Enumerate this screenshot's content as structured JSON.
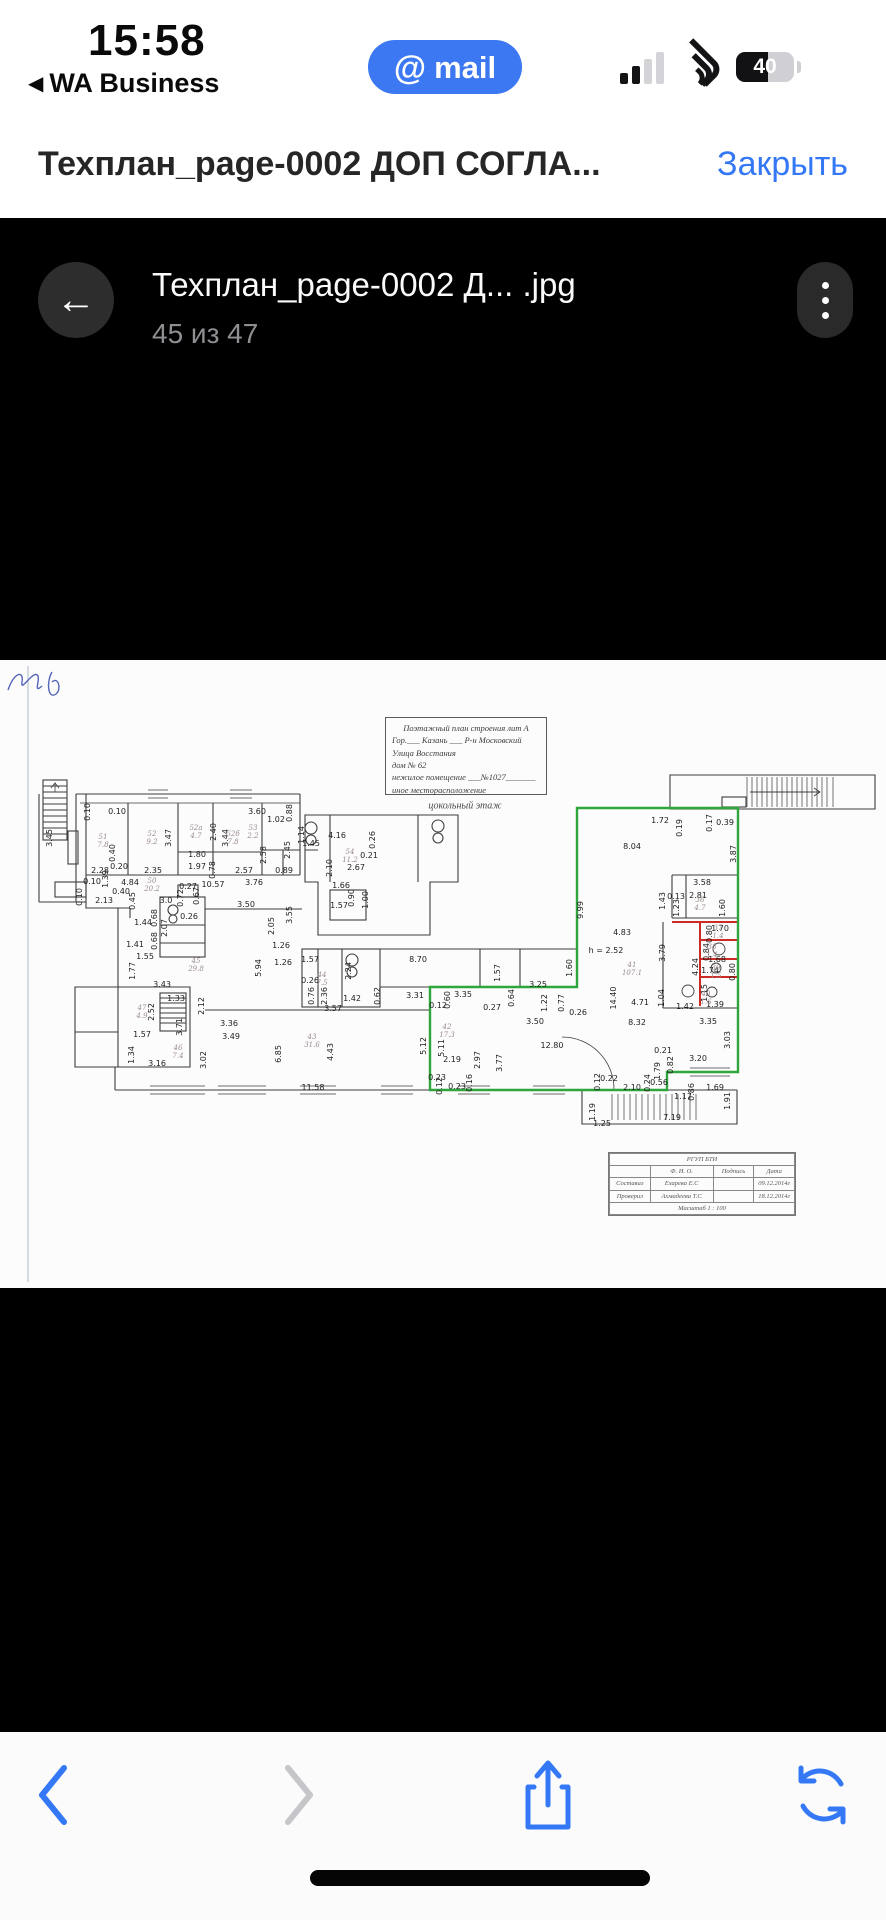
{
  "status_bar": {
    "time": "15:58",
    "back_app": "WA Business",
    "app_pill": {
      "at": "@",
      "word": "mail",
      "color": "#3b78f2"
    },
    "battery_percent": "40"
  },
  "header": {
    "title": "Техплан_page-0002 ДОП СОГЛА...",
    "close_label": "Закрыть",
    "accent_color": "#3478f6"
  },
  "viewer": {
    "filename": "Техплан_page-0002 Д... .jpg",
    "page_indicator": "45 из 47"
  },
  "floorplan": {
    "title_block": [
      "Поэтажный план строения лит А",
      "Гор.___ Казань ___ Р-н Московский",
      "Улица  Восстания",
      "дом № 62",
      "нежилое помещение ___№1027_______",
      "иное месторасположение"
    ],
    "floor_label": "цокольный этаж",
    "highlight_green": "#2ea63c",
    "highlight_red": "#cc2a22",
    "labels": [
      [
        "0.10",
        88,
        152,
        1
      ],
      [
        "0.10",
        117,
        152,
        0
      ],
      [
        "3.60",
        257,
        152,
        0
      ],
      [
        "1.02",
        276,
        160,
        0
      ],
      [
        "0.88",
        290,
        153,
        1
      ],
      [
        "3.45",
        50,
        178,
        1
      ],
      [
        "3.47",
        169,
        178,
        1
      ],
      [
        "2.40",
        214,
        172,
        1
      ],
      [
        "3.44",
        226,
        178,
        1
      ],
      [
        "0.40",
        113,
        193,
        1
      ],
      [
        "0.20",
        119,
        207,
        0
      ],
      [
        "2.28",
        100,
        211,
        0
      ],
      [
        "2.35",
        153,
        211,
        0
      ],
      [
        "1.80",
        197,
        195,
        0
      ],
      [
        "1.97",
        197,
        207,
        0
      ],
      [
        "0.78",
        213,
        210,
        1
      ],
      [
        "2.57",
        244,
        211,
        0
      ],
      [
        "3.76",
        254,
        223,
        0
      ],
      [
        "2.58",
        264,
        195,
        1
      ],
      [
        "2.45",
        288,
        190,
        1
      ],
      [
        "0.89",
        284,
        211,
        0
      ],
      [
        "4.84",
        130,
        223,
        0
      ],
      [
        "0.27",
        188,
        227,
        0
      ],
      [
        "10.57",
        213,
        225,
        0
      ],
      [
        "3.0",
        166,
        241,
        0
      ],
      [
        "0.72",
        181,
        238,
        1
      ],
      [
        "0.67",
        197,
        236,
        1
      ],
      [
        "0.40",
        121,
        232,
        0
      ],
      [
        "0.45",
        133,
        241,
        1
      ],
      [
        "2.13",
        104,
        241,
        0
      ],
      [
        "0.10",
        92,
        222,
        0
      ],
      [
        "0.10",
        80,
        237,
        1
      ],
      [
        "1.39",
        106,
        219,
        1
      ],
      [
        "0.26",
        189,
        257,
        0
      ],
      [
        "3.50",
        246,
        245,
        0
      ],
      [
        "3.55",
        290,
        255,
        1
      ],
      [
        "2.05",
        272,
        266,
        1
      ],
      [
        "1.26",
        281,
        286,
        0
      ],
      [
        "1.44",
        143,
        263,
        0
      ],
      [
        "0.68",
        155,
        258,
        1
      ],
      [
        "2.07",
        165,
        268,
        1
      ],
      [
        "1.41",
        135,
        285,
        0
      ],
      [
        "0.68",
        155,
        281,
        1
      ],
      [
        "1.55",
        145,
        297,
        0
      ],
      [
        "1.77",
        133,
        311,
        1
      ],
      [
        "5.94",
        259,
        308,
        1
      ],
      [
        "1.26",
        283,
        303,
        0
      ],
      [
        "1.14",
        302,
        175,
        1
      ],
      [
        "1.45",
        311,
        184,
        0
      ],
      [
        "4.16",
        337,
        176,
        0
      ],
      [
        "0.26",
        373,
        180,
        1
      ],
      [
        "0.21",
        369,
        196,
        0
      ],
      [
        "2.67",
        356,
        208,
        0
      ],
      [
        "2.10",
        330,
        208,
        1
      ],
      [
        "1.66",
        341,
        226,
        0
      ],
      [
        "1.57",
        339,
        246,
        0
      ],
      [
        "0.90",
        352,
        238,
        1
      ],
      [
        "1.00",
        366,
        240,
        1
      ],
      [
        "1.57",
        310,
        300,
        0
      ],
      [
        "2.24",
        349,
        311,
        1
      ],
      [
        "0.26",
        310,
        321,
        0
      ],
      [
        "0.76",
        312,
        336,
        1
      ],
      [
        "2.36",
        325,
        336,
        1
      ],
      [
        "1.42",
        352,
        339,
        0
      ],
      [
        "3.57",
        333,
        349,
        0
      ],
      [
        "0.62",
        378,
        336,
        1
      ],
      [
        "3.31",
        415,
        336,
        0
      ],
      [
        "8.70",
        418,
        300,
        0
      ],
      [
        "1.57",
        498,
        313,
        1
      ],
      [
        "3.25",
        538,
        325,
        0
      ],
      [
        "1.60",
        570,
        308,
        1
      ],
      [
        "1.72",
        660,
        161,
        0
      ],
      [
        "0.19",
        680,
        168,
        1
      ],
      [
        "0.17",
        710,
        163,
        1
      ],
      [
        "0.39",
        725,
        163,
        0
      ],
      [
        "8.04",
        632,
        187,
        0
      ],
      [
        "3.87",
        734,
        194,
        1
      ],
      [
        "9.99",
        581,
        250,
        1
      ],
      [
        "3.58",
        702,
        223,
        0
      ],
      [
        "0.13",
        676,
        237,
        0
      ],
      [
        "2.81",
        698,
        236,
        0
      ],
      [
        "1.43",
        663,
        241,
        1
      ],
      [
        "1.23",
        677,
        248,
        1
      ],
      [
        "1.60",
        723,
        248,
        1
      ],
      [
        "4.83",
        622,
        273,
        0
      ],
      [
        "h = 2.52",
        606,
        291,
        0
      ],
      [
        "3.79",
        663,
        293,
        1
      ],
      [
        "4.24",
        696,
        307,
        1
      ],
      [
        "1.70",
        720,
        269,
        0
      ],
      [
        "0.80",
        710,
        274,
        1
      ],
      [
        "0.84",
        707,
        292,
        1
      ],
      [
        "1.68",
        717,
        300,
        0
      ],
      [
        "1.74",
        710,
        311,
        0
      ],
      [
        "0.80",
        733,
        312,
        1
      ],
      [
        "1.15",
        705,
        333,
        1
      ],
      [
        "1.39",
        715,
        345,
        0
      ],
      [
        "1.42",
        685,
        347,
        0
      ],
      [
        "1.04",
        662,
        338,
        1
      ],
      [
        "4.71",
        640,
        343,
        0
      ],
      [
        "14.40",
        614,
        338,
        1
      ],
      [
        "8.32",
        637,
        363,
        0
      ],
      [
        "3.35",
        708,
        362,
        0
      ],
      [
        "3.03",
        728,
        380,
        1
      ],
      [
        "0.21",
        663,
        391,
        0
      ],
      [
        "3.20",
        698,
        399,
        0
      ],
      [
        "0.82",
        671,
        405,
        1
      ],
      [
        "1.79",
        658,
        411,
        1
      ],
      [
        "3.43",
        162,
        325,
        0
      ],
      [
        "1.33",
        176,
        339,
        0
      ],
      [
        "2.12",
        202,
        346,
        1
      ],
      [
        "2.52",
        152,
        352,
        1
      ],
      [
        "1.57",
        142,
        375,
        0
      ],
      [
        "3.71",
        180,
        367,
        1
      ],
      [
        "1.34",
        132,
        395,
        1
      ],
      [
        "3.16",
        157,
        404,
        0
      ],
      [
        "3.36",
        229,
        364,
        0
      ],
      [
        "3.49",
        231,
        377,
        0
      ],
      [
        "3.02",
        204,
        400,
        1
      ],
      [
        "6.85",
        279,
        394,
        1
      ],
      [
        "4.43",
        331,
        392,
        1
      ],
      [
        "11.58",
        313,
        428,
        0
      ],
      [
        "5.12",
        424,
        386,
        1
      ],
      [
        "5.11",
        442,
        388,
        1
      ],
      [
        "2.19",
        452,
        400,
        0
      ],
      [
        "2.97",
        478,
        400,
        1
      ],
      [
        "3.77",
        500,
        403,
        1
      ],
      [
        "12.80",
        552,
        386,
        0
      ],
      [
        "3.50",
        535,
        362,
        0
      ],
      [
        "0.26",
        578,
        353,
        0
      ],
      [
        "0.60",
        448,
        340,
        1
      ],
      [
        "0.12",
        438,
        346,
        0
      ],
      [
        "3.35",
        463,
        335,
        0
      ],
      [
        "0.27",
        492,
        348,
        0
      ],
      [
        "0.64",
        512,
        338,
        1
      ],
      [
        "1.22",
        545,
        343,
        1
      ],
      [
        "0.77",
        562,
        343,
        1
      ],
      [
        "0.23",
        437,
        418,
        0
      ],
      [
        "0.12",
        440,
        426,
        1
      ],
      [
        "0.23",
        457,
        427,
        0
      ],
      [
        "0.16",
        470,
        423,
        1
      ],
      [
        "0.12",
        598,
        422,
        1
      ],
      [
        "0.22",
        609,
        419,
        0
      ],
      [
        "2.10",
        632,
        428,
        0
      ],
      [
        "0.24",
        648,
        423,
        1
      ],
      [
        "0.56",
        659,
        423,
        0
      ],
      [
        "1.17",
        683,
        437,
        0
      ],
      [
        "0.86",
        692,
        432,
        1
      ],
      [
        "1.69",
        715,
        428,
        0
      ],
      [
        "1.91",
        728,
        441,
        1
      ],
      [
        "1.19",
        593,
        452,
        1
      ],
      [
        "1.25",
        602,
        464,
        0
      ],
      [
        "7.19",
        672,
        458,
        0
      ]
    ],
    "room_labels": [
      [
        "51\n7.8",
        103,
        181
      ],
      [
        "52\n9.2",
        152,
        178
      ],
      [
        "52а\n4.7",
        196,
        172
      ],
      [
        "52б\n7.8",
        233,
        178
      ],
      [
        "53\n2.2",
        253,
        172
      ],
      [
        "54\n11.2",
        350,
        196
      ],
      [
        "50\n20.2",
        152,
        225
      ],
      [
        "45\n29.8",
        196,
        305
      ],
      [
        "44\n7.5",
        322,
        319
      ],
      [
        "46\n7.4",
        178,
        392
      ],
      [
        "47\n4.9",
        142,
        352
      ],
      [
        "43\n31.6",
        312,
        381
      ],
      [
        "42\n17.3",
        447,
        371
      ],
      [
        "41\n107.1",
        632,
        309
      ],
      [
        "36\n4.7",
        700,
        244
      ],
      [
        "37\n1.4",
        718,
        272
      ],
      [
        "38\n1.4",
        712,
        291
      ],
      [
        "39\n1.5",
        716,
        312
      ],
      [
        "40\n1.6",
        706,
        338
      ]
    ],
    "stamp": {
      "org": "РГУП БТИ",
      "col_fio": "Ф. И. О.",
      "col_sign": "Подпись",
      "col_date": "Дата",
      "rows": [
        {
          "role": "Составил",
          "fio": "Ехарева Е.С",
          "date": "09.12.2014г"
        },
        {
          "role": "Проверил",
          "fio": "Ахмадеева Т.С",
          "date": "18.12.2014г"
        }
      ],
      "scale": "Масштаб 1 : 100"
    }
  },
  "toolbar": {
    "back": "back-chevron",
    "forward": "forward-chevron",
    "share": "share",
    "reload": "reload"
  }
}
